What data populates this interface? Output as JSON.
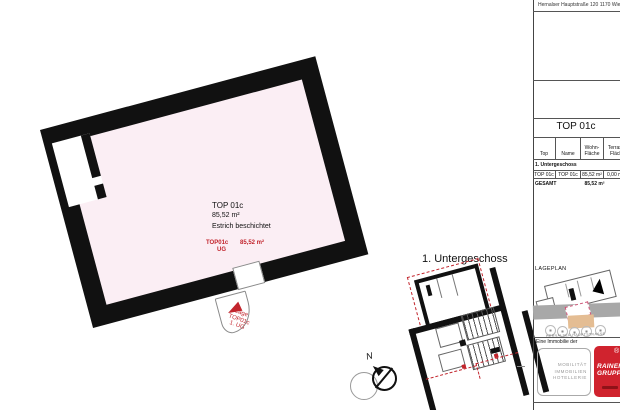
{
  "sheet": {
    "address": "Hernalser Hauptstraße 120 1170 Wien",
    "unit_heading": "TOP 01c"
  },
  "main_plan": {
    "unit": "TOP 01c",
    "area": "85,52 m²",
    "finish": "Estrich beschichtet",
    "stamp_unit": "TOP01c",
    "stamp_floor": "UG",
    "stamp_area": "85,52 m²",
    "callout_line1": "Lage",
    "callout_line2": "TOP01c",
    "callout_line3": "1. UG"
  },
  "overview_plan": {
    "title": "1. Untergeschoss",
    "north": "N"
  },
  "sidebar": {
    "table": {
      "col_top": "Top",
      "col_name": "Name",
      "col_wohn_1": "Wohn-",
      "col_wohn_2": "Fläche",
      "col_terrasse_1": "Terrasse",
      "col_terrasse_2": "Fläche",
      "section": "1. Untergeschoss",
      "row": {
        "top": "TOP 01c",
        "name": "TOP 01c",
        "wohn": "85,52 m²",
        "terrasse": "0,00 m²"
      },
      "gesamt_label": "GESAMT",
      "gesamt_wohn": "85,52 m²"
    },
    "lageplan_label": "LAGEPLAN",
    "street_label": "HERNALSER HAUPTSTRASSE",
    "brand_intro": "Eine Immobilie der",
    "brand_field_1": "MOBILITÄT",
    "brand_field_2": "IMMOBILIEN",
    "brand_field_3": "HOTELLERIE",
    "logo_name_1": "RAINER",
    "logo_name_2": "GRUPPE",
    "logo_registered": "®"
  },
  "colors": {
    "plan_fill": "#fbeef4",
    "wall": "#111111",
    "annotation_red": "#c2252d",
    "logo_red": "#d0232e",
    "street_gray": "#a8a8a8",
    "parcel_tan": "#e4bd93"
  }
}
